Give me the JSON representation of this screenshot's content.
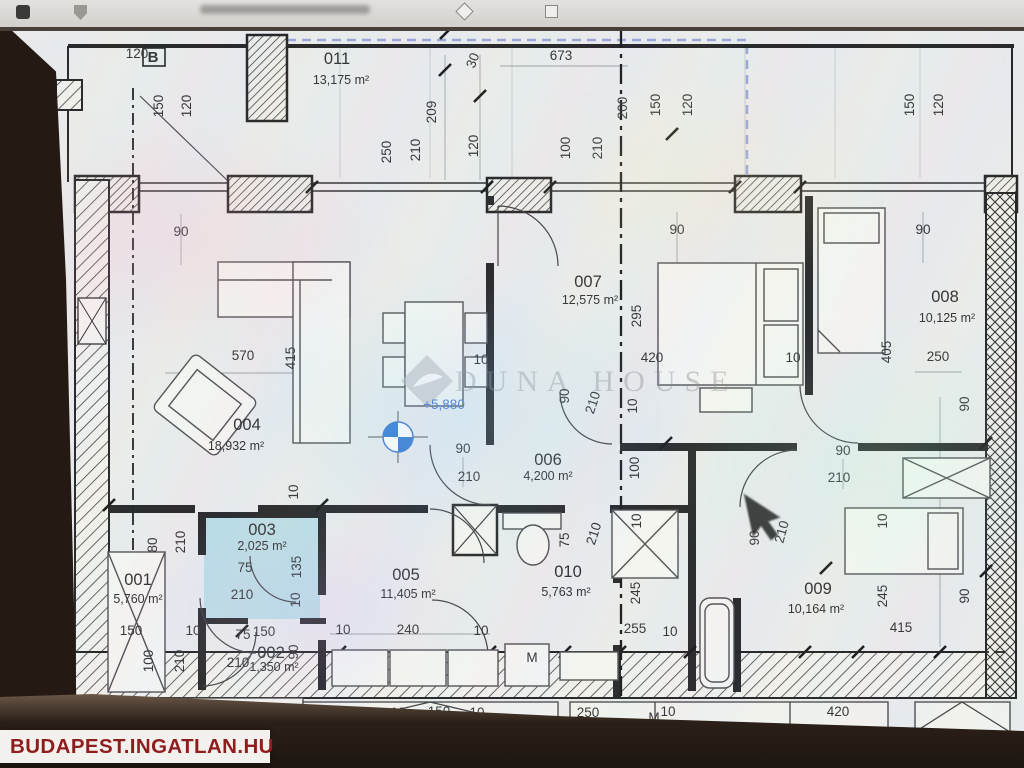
{
  "browser": {
    "icon_names": [
      "favicon-icon",
      "shield-icon",
      "diamond-icon",
      "stop-icon"
    ]
  },
  "watermark": {
    "text": "DUNA HOUSE"
  },
  "branding": {
    "site": "BUDAPEST.INGATLAN.HU"
  },
  "plan": {
    "highlight_color": "#aed9e4",
    "accent_blue": "#3f74cc",
    "terrace_dash_color": "#97a3d8",
    "rooms": [
      {
        "num": "001",
        "area": "5,760 m²",
        "x": 138,
        "y": 585,
        "ax": 138,
        "ay": 603
      },
      {
        "num": "002",
        "area": "1,350 m²",
        "x": 271,
        "y": 658,
        "ax": 274,
        "ay": 671,
        "as": 10
      },
      {
        "num": "003",
        "area": "2,025 m²",
        "x": 262,
        "y": 535,
        "ax": 262,
        "ay": 550,
        "as": 10.5
      },
      {
        "num": "004",
        "area": "18,932 m²",
        "x": 247,
        "y": 430,
        "ax": 236,
        "ay": 450
      },
      {
        "num": "005",
        "area": "11,405 m²",
        "x": 406,
        "y": 580,
        "ax": 408,
        "ay": 598
      },
      {
        "num": "006",
        "area": "4,200 m²",
        "x": 548,
        "y": 465,
        "ax": 548,
        "ay": 480,
        "as": 11
      },
      {
        "num": "007",
        "area": "12,575 m²",
        "x": 588,
        "y": 287,
        "ax": 590,
        "ay": 304
      },
      {
        "num": "008",
        "area": "10,125 m²",
        "x": 945,
        "y": 302,
        "ax": 947,
        "ay": 322
      },
      {
        "num": "009",
        "area": "10,164 m²",
        "x": 818,
        "y": 594,
        "ax": 816,
        "ay": 613
      },
      {
        "num": "010",
        "area": "5,763 m²",
        "x": 568,
        "y": 577,
        "ax": 566,
        "ay": 596
      },
      {
        "num": "011",
        "area": "13,175 m²",
        "x": 337,
        "y": 64,
        "ax": 341,
        "ay": 84
      }
    ],
    "labels": [
      {
        "t": "100",
        "x": 134,
        "y": 27
      },
      {
        "t": "120",
        "x": 137,
        "y": 58
      },
      {
        "t": "B",
        "x": 153,
        "y": 62,
        "c": "boldb"
      },
      {
        "t": "150",
        "x": 163,
        "y": 106,
        "r": -90
      },
      {
        "t": "120",
        "x": 191,
        "y": 106,
        "r": -90
      },
      {
        "t": "209",
        "x": 436,
        "y": 112,
        "r": -90
      },
      {
        "t": "30",
        "x": 477,
        "y": 62,
        "r": -70
      },
      {
        "t": "673",
        "x": 561,
        "y": 60
      },
      {
        "t": "250",
        "x": 391,
        "y": 152,
        "r": -90
      },
      {
        "t": "210",
        "x": 420,
        "y": 150,
        "r": -90
      },
      {
        "t": "120",
        "x": 478,
        "y": 146,
        "r": -90
      },
      {
        "t": "100",
        "x": 570,
        "y": 148,
        "r": -90
      },
      {
        "t": "210",
        "x": 602,
        "y": 148,
        "r": -90
      },
      {
        "t": "200",
        "x": 627,
        "y": 108,
        "r": -90
      },
      {
        "t": "150",
        "x": 660,
        "y": 105,
        "r": -90
      },
      {
        "t": "120",
        "x": 692,
        "y": 105,
        "r": -90
      },
      {
        "t": "150",
        "x": 914,
        "y": 105,
        "r": -90
      },
      {
        "t": "120",
        "x": 943,
        "y": 105,
        "r": -90
      },
      {
        "t": "90",
        "x": 181,
        "y": 236
      },
      {
        "t": "90",
        "x": 677,
        "y": 234
      },
      {
        "t": "90",
        "x": 923,
        "y": 234
      },
      {
        "t": "570",
        "x": 243,
        "y": 360
      },
      {
        "t": "415",
        "x": 295,
        "y": 358,
        "r": -90,
        "s": 11.5
      },
      {
        "t": "295",
        "x": 641,
        "y": 316,
        "r": -90
      },
      {
        "t": "420",
        "x": 652,
        "y": 362
      },
      {
        "t": "10",
        "x": 793,
        "y": 362,
        "s": 11.5
      },
      {
        "t": "10",
        "x": 481,
        "y": 364,
        "s": 11.5
      },
      {
        "t": "405",
        "x": 891,
        "y": 352,
        "r": -90,
        "s": 11.5
      },
      {
        "t": "250",
        "x": 938,
        "y": 361
      },
      {
        "t": "90",
        "x": 969,
        "y": 404,
        "r": -90
      },
      {
        "t": "90",
        "x": 463,
        "y": 453
      },
      {
        "t": "210",
        "x": 469,
        "y": 481
      },
      {
        "t": "90",
        "x": 569,
        "y": 396,
        "r": -90
      },
      {
        "t": "210",
        "x": 597,
        "y": 404,
        "r": -72
      },
      {
        "t": "100",
        "x": 639,
        "y": 468,
        "r": -90
      },
      {
        "t": "10",
        "x": 641,
        "y": 521,
        "r": -90,
        "s": 11.5
      },
      {
        "t": "10",
        "x": 637,
        "y": 406,
        "r": -90,
        "s": 11.5
      },
      {
        "t": "75",
        "x": 569,
        "y": 540,
        "r": -90
      },
      {
        "t": "210",
        "x": 598,
        "y": 535,
        "r": -72
      },
      {
        "t": "245",
        "x": 640,
        "y": 593,
        "r": -90
      },
      {
        "t": "255",
        "x": 635,
        "y": 633
      },
      {
        "t": "10",
        "x": 670,
        "y": 636,
        "s": 11.5
      },
      {
        "t": "80",
        "x": 157,
        "y": 545,
        "r": -90
      },
      {
        "t": "210",
        "x": 185,
        "y": 542,
        "r": -90
      },
      {
        "t": "10",
        "x": 298,
        "y": 492,
        "r": -90,
        "s": 11.5
      },
      {
        "t": "75",
        "x": 245,
        "y": 572
      },
      {
        "t": "210",
        "x": 242,
        "y": 599
      },
      {
        "t": "135",
        "x": 301,
        "y": 567,
        "r": -90
      },
      {
        "t": "10",
        "x": 300,
        "y": 600,
        "r": -90,
        "s": 11.5
      },
      {
        "t": "150",
        "x": 131,
        "y": 635
      },
      {
        "t": "10",
        "x": 193,
        "y": 635,
        "s": 11.5
      },
      {
        "t": "100",
        "x": 153,
        "y": 661,
        "r": -90
      },
      {
        "t": "210",
        "x": 184,
        "y": 661,
        "r": -90
      },
      {
        "t": "75",
        "x": 243,
        "y": 639
      },
      {
        "t": "150",
        "x": 264,
        "y": 636,
        "s": 11.5
      },
      {
        "t": "210",
        "x": 238,
        "y": 667
      },
      {
        "t": "90",
        "x": 298,
        "y": 652,
        "r": -90,
        "s": 11.5
      },
      {
        "t": "10",
        "x": 343,
        "y": 634,
        "s": 11.5
      },
      {
        "t": "240",
        "x": 408,
        "y": 634
      },
      {
        "t": "10",
        "x": 481,
        "y": 635,
        "s": 11.5
      },
      {
        "t": "M",
        "x": 532,
        "y": 662,
        "s": 11.5
      },
      {
        "t": "250",
        "x": 588,
        "y": 717
      },
      {
        "t": "M",
        "x": 654,
        "y": 722,
        "s": 10.5
      },
      {
        "t": "10",
        "x": 668,
        "y": 716,
        "s": 11.5
      },
      {
        "t": "90",
        "x": 843,
        "y": 455
      },
      {
        "t": "210",
        "x": 839,
        "y": 482
      },
      {
        "t": "90",
        "x": 759,
        "y": 538,
        "r": -90
      },
      {
        "t": "210",
        "x": 786,
        "y": 533,
        "r": -75
      },
      {
        "t": "10",
        "x": 887,
        "y": 521,
        "r": -90,
        "s": 11.5
      },
      {
        "t": "245",
        "x": 887,
        "y": 596,
        "r": -90
      },
      {
        "t": "415",
        "x": 901,
        "y": 632
      },
      {
        "t": "90",
        "x": 969,
        "y": 596,
        "r": -90
      },
      {
        "t": "420",
        "x": 838,
        "y": 716
      },
      {
        "t": "120",
        "x": 334,
        "y": 716
      },
      {
        "t": "10",
        "x": 398,
        "y": 717,
        "s": 11.5
      },
      {
        "t": "150",
        "x": 439,
        "y": 716
      },
      {
        "t": "10",
        "x": 477,
        "y": 717,
        "s": 11.5
      },
      {
        "t": "+5,880",
        "x": 444,
        "y": 409,
        "c": "blue",
        "s": 17
      },
      {
        "t": "+5,880",
        "x": 253,
        "y": 715,
        "c": "blue",
        "s": 16
      },
      {
        "t": "B-201",
        "x": 168,
        "y": 732,
        "c": "blue2",
        "s": 12
      }
    ]
  }
}
